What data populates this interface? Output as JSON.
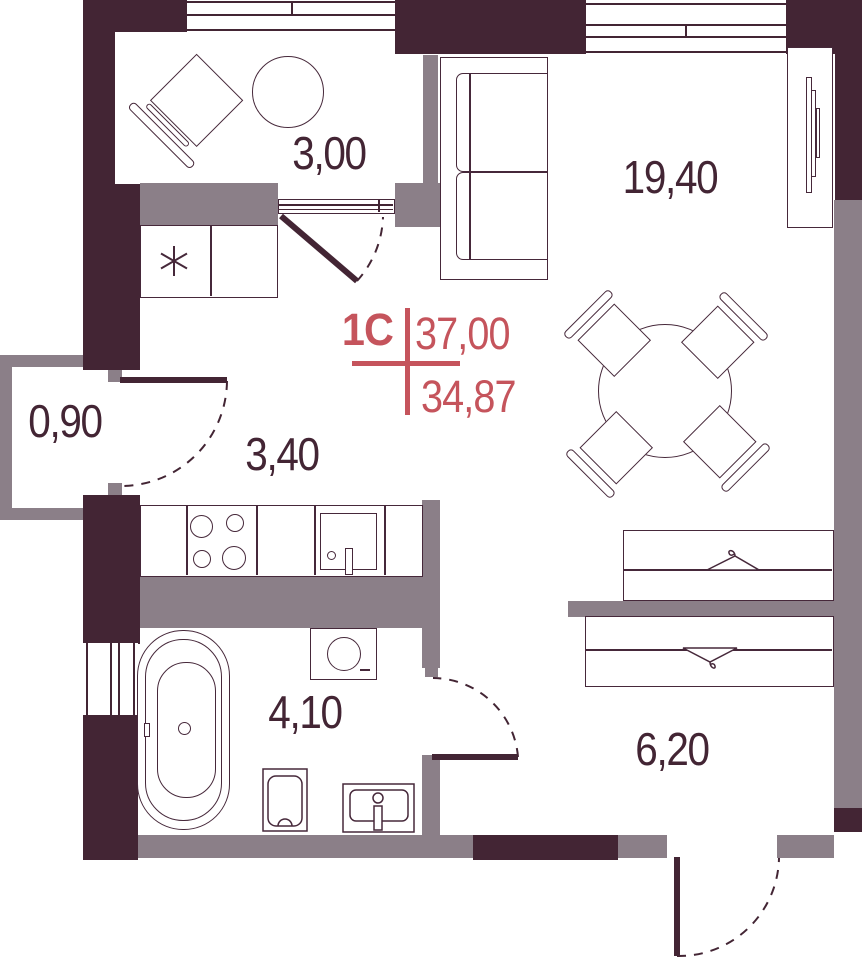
{
  "title": {
    "type": "1С",
    "total_area": "37,00",
    "living_area": "34,87"
  },
  "rooms": {
    "balcony": {
      "area": "3,00"
    },
    "living": {
      "area": "19,40"
    },
    "storage": {
      "area": "0,90"
    },
    "hallway": {
      "area": "3,40"
    },
    "bathroom": {
      "area": "4,10"
    },
    "entry": {
      "area": "6,20"
    }
  },
  "colors": {
    "wall_dark": "#432534",
    "wall_light": "#8B7F88",
    "accent_red": "#C5545C",
    "furniture_line": "#46283A",
    "background": "#FFFFFF"
  },
  "icons": {
    "hanger_up": "hanger-icon",
    "hanger_down": "hanger-icon",
    "fridge_asterisk": "asterisk-icon"
  }
}
